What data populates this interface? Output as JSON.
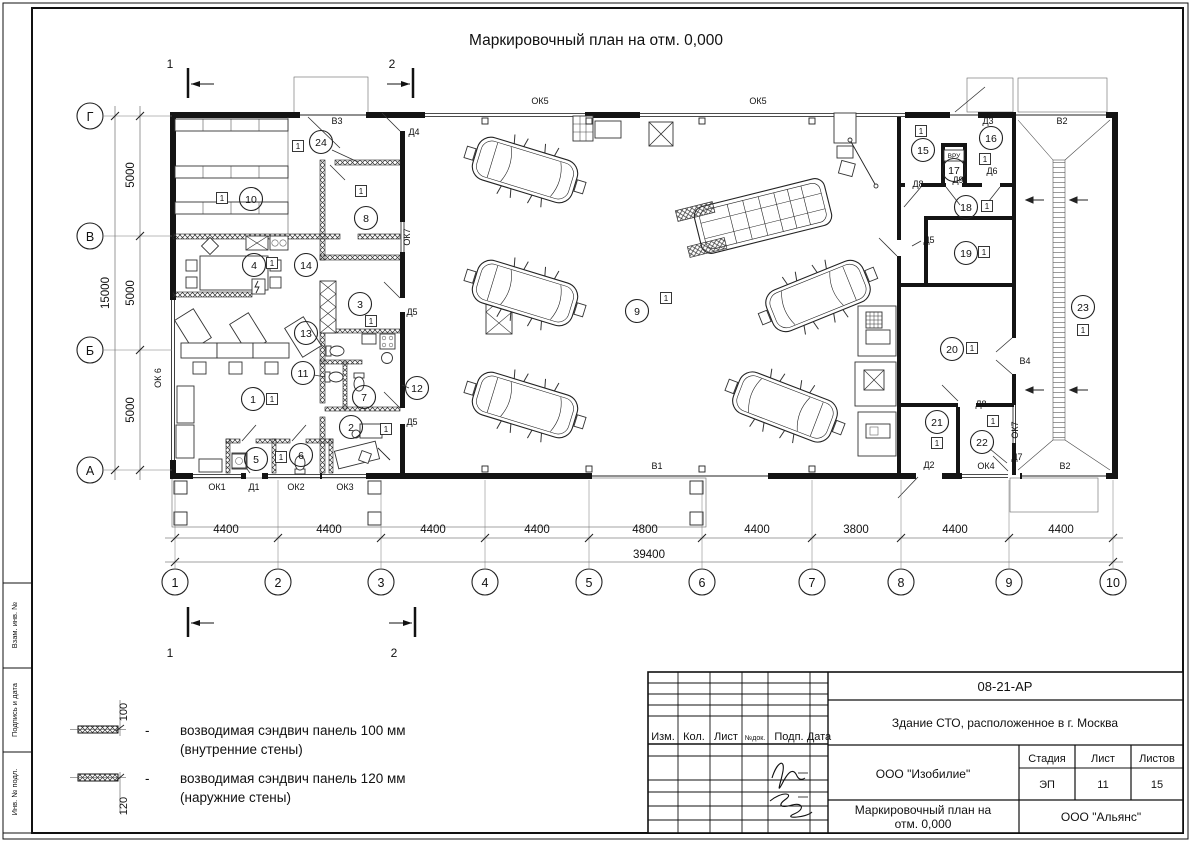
{
  "sheet": {
    "title": "Маркировочный план на отм. 0,000",
    "doc_code": "08-21-АР",
    "project": "Здание СТО, расположенное в г. Москва",
    "company": "ООО \"Изобилие\"",
    "drawing_name_line1": "Маркировочный план на",
    "drawing_name_line2": "отм. 0,000",
    "contractor": "ООО \"Альянс\"",
    "stage_label": "Стадия",
    "sheet_label": "Лист",
    "sheets_label": "Листов",
    "stage": "ЭП",
    "sheet_no": "11",
    "sheets_total": "15",
    "header_cols": [
      "Изм.",
      "Кол.",
      "Лист",
      "№док.",
      "Подп.",
      "Дата"
    ],
    "rows": [
      {
        "role": "Разработал",
        "name": "Шабалина",
        "date": "04.21"
      },
      {
        "role": "Н. контр.",
        "name": "Двоеглазов",
        "date": "04.21"
      },
      {
        "role": "ГИП",
        "name": "Коротаев",
        "date": "04.21"
      }
    ],
    "side_labels": [
      "Взам. инв. №",
      "Подпись и дата",
      "Инв. № подл."
    ]
  },
  "legend": {
    "items": [
      {
        "dim": "100",
        "dash": "-",
        "line1": "возводимая сэндвич панель 100 мм",
        "line2": "(внутренние стены)"
      },
      {
        "dim": "120",
        "dash": "-",
        "line1": "возводимая сэндвич панель 120 мм",
        "line2": "(наружние стены)"
      }
    ]
  },
  "plan": {
    "tag_label": "1",
    "axes_h": [
      {
        "label": "1",
        "x": 175
      },
      {
        "label": "2",
        "x": 278
      },
      {
        "label": "3",
        "x": 381
      },
      {
        "label": "4",
        "x": 485
      },
      {
        "label": "5",
        "x": 589
      },
      {
        "label": "6",
        "x": 702
      },
      {
        "label": "7",
        "x": 812
      },
      {
        "label": "8",
        "x": 901
      },
      {
        "label": "9",
        "x": 1009
      },
      {
        "label": "10",
        "x": 1113
      }
    ],
    "axes_v": [
      {
        "label": "Г",
        "y": 116
      },
      {
        "label": "В",
        "y": 236
      },
      {
        "label": "Б",
        "y": 350
      },
      {
        "label": "А",
        "y": 470
      }
    ],
    "dims_bottom": [
      {
        "label": "4400",
        "x": 226
      },
      {
        "label": "4400",
        "x": 329
      },
      {
        "label": "4400",
        "x": 433
      },
      {
        "label": "4400",
        "x": 537
      },
      {
        "label": "4800",
        "x": 645
      },
      {
        "label": "4400",
        "x": 757
      },
      {
        "label": "3800",
        "x": 856
      },
      {
        "label": "4400",
        "x": 955
      },
      {
        "label": "4400",
        "x": 1061
      }
    ],
    "dim_total": "39400",
    "dims_left": [
      {
        "label": "5000",
        "y": 175
      },
      {
        "label": "5000",
        "y": 293
      },
      {
        "label": "5000",
        "y": 410
      }
    ],
    "dim_left_total": "15000",
    "sections": [
      {
        "label": "1",
        "x": 170,
        "y": 64
      },
      {
        "label": "2",
        "x": 392,
        "y": 64
      },
      {
        "label": "1",
        "x": 170,
        "y": 653
      },
      {
        "label": "2",
        "x": 394,
        "y": 653
      }
    ],
    "rooms": [
      {
        "n": "1",
        "x": 253,
        "y": 399
      },
      {
        "n": "2",
        "x": 351,
        "y": 427
      },
      {
        "n": "3",
        "x": 360,
        "y": 304
      },
      {
        "n": "4",
        "x": 254,
        "y": 265
      },
      {
        "n": "5",
        "x": 256,
        "y": 459
      },
      {
        "n": "6",
        "x": 301,
        "y": 455
      },
      {
        "n": "7",
        "x": 364,
        "y": 397
      },
      {
        "n": "8",
        "x": 366,
        "y": 218
      },
      {
        "n": "9",
        "x": 637,
        "y": 311
      },
      {
        "n": "10",
        "x": 251,
        "y": 199
      },
      {
        "n": "11",
        "x": 303,
        "y": 373
      },
      {
        "n": "12",
        "x": 417,
        "y": 388
      },
      {
        "n": "13",
        "x": 306,
        "y": 333
      },
      {
        "n": "14",
        "x": 306,
        "y": 265
      },
      {
        "n": "15",
        "x": 923,
        "y": 150
      },
      {
        "n": "16",
        "x": 991,
        "y": 138
      },
      {
        "n": "17",
        "x": 954,
        "y": 170
      },
      {
        "n": "18",
        "x": 966,
        "y": 207
      },
      {
        "n": "19",
        "x": 966,
        "y": 253
      },
      {
        "n": "20",
        "x": 952,
        "y": 349
      },
      {
        "n": "21",
        "x": 937,
        "y": 422
      },
      {
        "n": "22",
        "x": 982,
        "y": 442
      },
      {
        "n": "23",
        "x": 1083,
        "y": 307
      },
      {
        "n": "24",
        "x": 321,
        "y": 142
      }
    ],
    "tags": [
      {
        "x": 222,
        "y": 198
      },
      {
        "x": 272,
        "y": 263
      },
      {
        "x": 272,
        "y": 399
      },
      {
        "x": 281,
        "y": 457
      },
      {
        "x": 361,
        "y": 191
      },
      {
        "x": 371,
        "y": 321
      },
      {
        "x": 386,
        "y": 429
      },
      {
        "x": 666,
        "y": 298
      },
      {
        "x": 921,
        "y": 131
      },
      {
        "x": 985,
        "y": 159
      },
      {
        "x": 987,
        "y": 206
      },
      {
        "x": 984,
        "y": 252
      },
      {
        "x": 972,
        "y": 348
      },
      {
        "x": 937,
        "y": 443
      },
      {
        "x": 993,
        "y": 421
      },
      {
        "x": 1083,
        "y": 330
      },
      {
        "x": 298,
        "y": 146
      }
    ],
    "openings": [
      {
        "t": "ОК5",
        "x": 540,
        "y": 104
      },
      {
        "t": "ОК5",
        "x": 758,
        "y": 104
      },
      {
        "t": "В3",
        "x": 337,
        "y": 124
      },
      {
        "t": "Д3",
        "x": 988,
        "y": 124
      },
      {
        "t": "В2",
        "x": 1062,
        "y": 124
      },
      {
        "t": "Д4",
        "x": 414,
        "y": 135
      },
      {
        "t": "ОК7",
        "x": 410,
        "y": 237,
        "r": -90
      },
      {
        "t": "Д5",
        "x": 412,
        "y": 315
      },
      {
        "t": "Д5",
        "x": 412,
        "y": 425
      },
      {
        "t": "ОК 6",
        "x": 161,
        "y": 378,
        "r": -90
      },
      {
        "t": "ОК1",
        "x": 217,
        "y": 490
      },
      {
        "t": "Д1",
        "x": 254,
        "y": 490
      },
      {
        "t": "ОК2",
        "x": 296,
        "y": 490
      },
      {
        "t": "ОК3",
        "x": 345,
        "y": 490
      },
      {
        "t": "В1",
        "x": 657,
        "y": 469
      },
      {
        "t": "Д2",
        "x": 929,
        "y": 468
      },
      {
        "t": "ОК4",
        "x": 986,
        "y": 469
      },
      {
        "t": "Д7",
        "x": 1017,
        "y": 460
      },
      {
        "t": "В2",
        "x": 1065,
        "y": 469
      },
      {
        "t": "Д8",
        "x": 918,
        "y": 187
      },
      {
        "t": "Д9",
        "x": 958,
        "y": 183
      },
      {
        "t": "Д6",
        "x": 992,
        "y": 174
      },
      {
        "t": "Д5",
        "x": 929,
        "y": 243
      },
      {
        "t": "В4",
        "x": 1025,
        "y": 364
      },
      {
        "t": "Д8",
        "x": 981,
        "y": 407
      },
      {
        "t": "ОК7",
        "x": 1018,
        "y": 430,
        "r": -90
      }
    ],
    "vru_label": "ВРУ"
  }
}
